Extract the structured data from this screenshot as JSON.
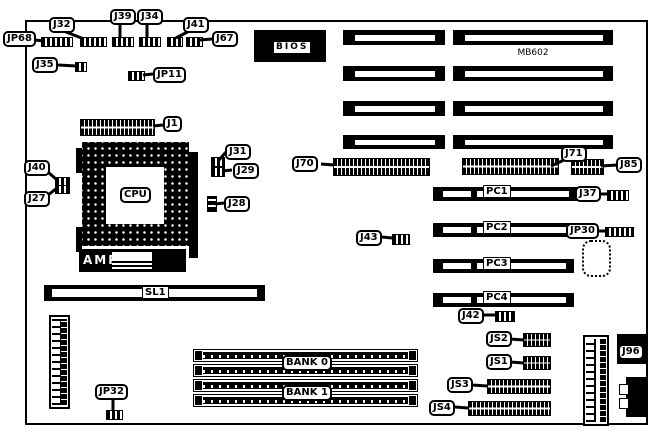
{
  "diagram": {
    "model_text": "MB602"
  },
  "chips": {
    "bios": "BIOS",
    "cpu": "CPU",
    "amp": "AMP",
    "j96": "J96"
  },
  "slots": {
    "sl1": "SL1",
    "pci": [
      "PC1",
      "PC2",
      "PC3",
      "PC4"
    ],
    "banks": [
      "BANK 0",
      "BANK 1"
    ]
  },
  "connectors": {
    "jp68": "JP68",
    "j32": "J32",
    "j39": "J39",
    "j34": "J34",
    "j41": "J41",
    "j67": "J67",
    "j35": "J35",
    "jp11": "JP11",
    "j1": "J1",
    "j31": "J31",
    "j29": "J29",
    "j28": "J28",
    "j40": "J40",
    "j27": "J27",
    "j70": "J70",
    "j71": "J71",
    "j85": "J85",
    "j37": "J37",
    "jp30": "JP30",
    "j43": "J43",
    "j42": "J42",
    "jp32": "JP32",
    "js1": "JS1",
    "js2": "JS2",
    "js3": "JS3",
    "js4": "JS4"
  }
}
